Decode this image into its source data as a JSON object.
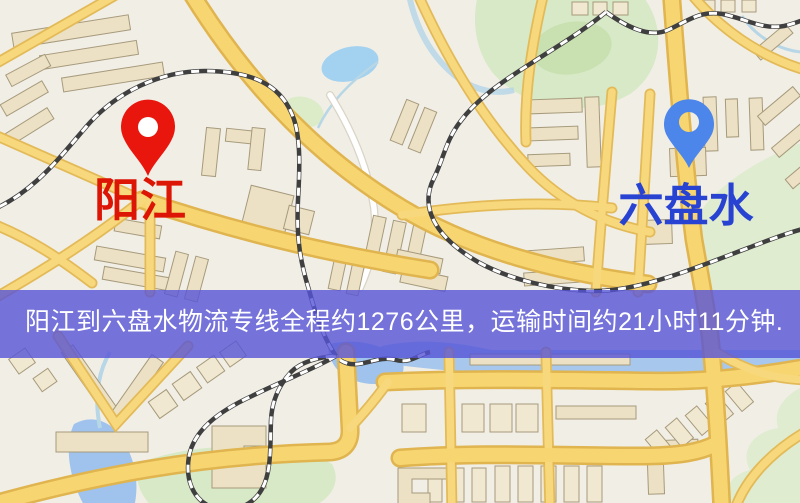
{
  "window": {
    "width": 800,
    "height": 503,
    "type": "map-view"
  },
  "map": {
    "markers": {
      "origin": {
        "name": "阳江",
        "pin_color": "#e8160c",
        "label_color": "#dc1505"
      },
      "destination": {
        "name": "六盘水",
        "pin_color": "#4c86ea",
        "label_color": "#2842d2"
      }
    },
    "banner": {
      "text": "阳江到六盘水物流专线全程约1276公里，运输时间约21小时11分钟.",
      "background_color": "rgba(86,84,215,0.80)",
      "text_color": "#ffffff",
      "distance_km": "1276",
      "duration": "21小时11分钟"
    },
    "palette": {
      "land": "#f1eee6",
      "road_fill": "#f7d672",
      "road_casing": "#e0b44e",
      "water": "#9fc3ec",
      "park": "#d7e9c6",
      "building": "#ece1c4",
      "railway": "#3f3f3f"
    }
  }
}
